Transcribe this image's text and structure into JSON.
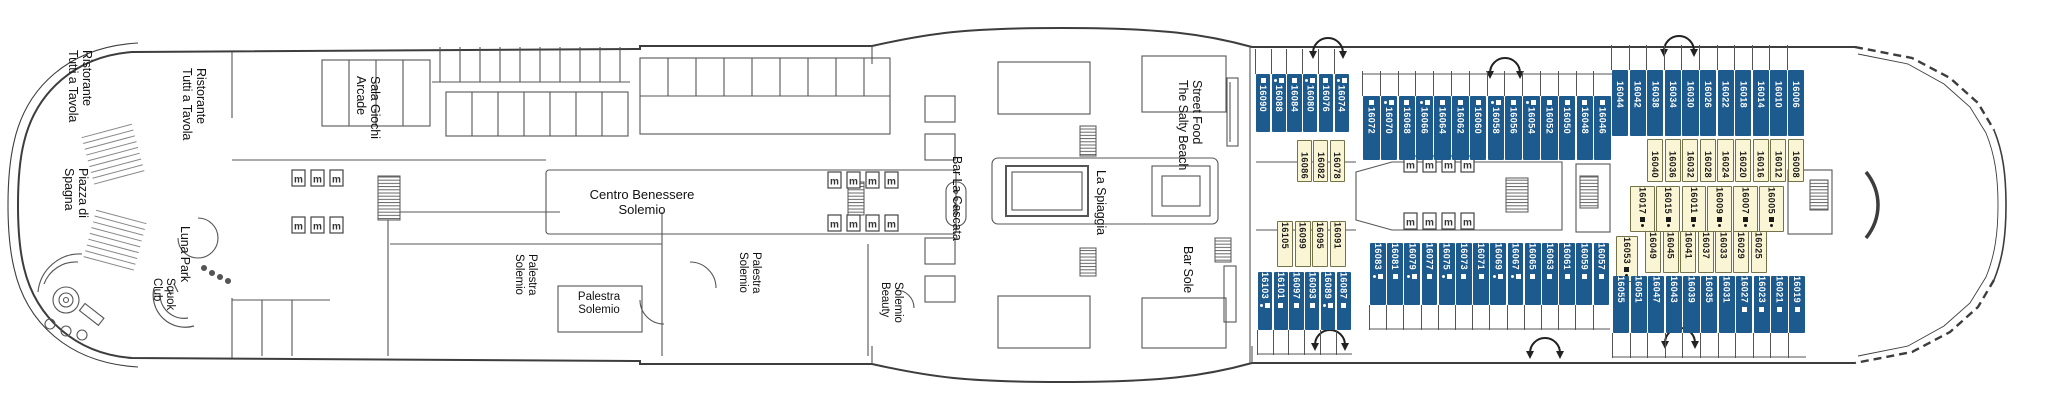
{
  "deck_plan": {
    "colors": {
      "balcony_cabin": "#1d5a8e",
      "inside_cabin": "#faf5d4",
      "inside_cabin_border": "#73734a",
      "outline": "#3d3d3d",
      "label_text": "#111111"
    },
    "legend_icons": {
      "elevator_label": "m",
      "berth_square": "square",
      "berth_dot": "dot"
    },
    "ship_areas": {
      "ristorante_aft": {
        "label": "Ristorante\nTutti a Tavola"
      },
      "ristorante_fwd": {
        "label": "Ristorante\nTutti a Tavola"
      },
      "piazza_di_spagna": {
        "label": "Piazza di\nSpagna"
      },
      "luna_park": {
        "label": "Luna Park"
      },
      "squok_club": {
        "label": "Squok\nClub"
      },
      "sala_giochi_arcade": {
        "label": "Sala Giochi\nArcade"
      },
      "centro_benessere": {
        "label": "Centro Benessere\nSolemio"
      },
      "palestra_solemio_port": {
        "label": "Palestra\nSolemio"
      },
      "palestra_solemio_room": {
        "label": "Palestra\nSolemio"
      },
      "palestra_solemio_stbd": {
        "label": "Palestra\nSolemio"
      },
      "solemio_beauty": {
        "label": "Solemio\nBeauty"
      },
      "bar_la_cascata": {
        "label": "Bar La Cascata"
      },
      "la_spiaggia": {
        "label": "La Spiaggia"
      },
      "salty_beach": {
        "label": "The Salty Beach\nStreet Food"
      },
      "bar_sole": {
        "label": "Bar Sole"
      }
    },
    "cabins": {
      "groups": [
        {
          "id": "t1",
          "type": "balcony",
          "side": "port",
          "cabins": [
            {
              "num": "16090",
              "icons": [
                "square"
              ]
            },
            {
              "num": "16088",
              "icons": [
                "dot",
                "square"
              ]
            },
            {
              "num": "16084",
              "icons": [
                "square"
              ]
            },
            {
              "num": "16080",
              "icons": [
                "dot",
                "square"
              ]
            },
            {
              "num": "16076",
              "icons": [
                "square"
              ]
            },
            {
              "num": "16074",
              "icons": [
                "dot",
                "square"
              ]
            }
          ]
        },
        {
          "id": "t2",
          "type": "balcony",
          "side": "port",
          "cabins": [
            {
              "num": "16072",
              "icons": [
                "square"
              ]
            },
            {
              "num": "16070",
              "icons": [
                "dot",
                "square"
              ]
            },
            {
              "num": "16068",
              "icons": [
                "square"
              ]
            },
            {
              "num": "16066",
              "icons": [
                "dot",
                "square"
              ]
            },
            {
              "num": "16064",
              "icons": [
                "square"
              ]
            },
            {
              "num": "16062",
              "icons": [
                "square"
              ]
            },
            {
              "num": "16060",
              "icons": [
                "square"
              ]
            },
            {
              "num": "16058",
              "icons": [
                "dot",
                "square"
              ]
            },
            {
              "num": "16056",
              "icons": [
                "square"
              ]
            },
            {
              "num": "16054",
              "icons": [
                "dot",
                "square"
              ]
            },
            {
              "num": "16052",
              "icons": [
                "square"
              ]
            },
            {
              "num": "16050",
              "icons": [
                "square"
              ]
            },
            {
              "num": "16048",
              "icons": [
                "square"
              ]
            },
            {
              "num": "16046",
              "icons": [
                "square"
              ]
            }
          ]
        },
        {
          "id": "t3",
          "type": "balcony",
          "side": "port",
          "cabins": [
            {
              "num": "16044",
              "icons": []
            },
            {
              "num": "16042",
              "icons": []
            },
            {
              "num": "16038",
              "icons": []
            },
            {
              "num": "16034",
              "icons": []
            },
            {
              "num": "16030",
              "icons": []
            },
            {
              "num": "16026",
              "icons": []
            },
            {
              "num": "16022",
              "icons": []
            },
            {
              "num": "16018",
              "icons": []
            },
            {
              "num": "16014",
              "icons": []
            },
            {
              "num": "16010",
              "icons": []
            },
            {
              "num": "16006",
              "icons": []
            }
          ]
        },
        {
          "id": "y1",
          "type": "inside",
          "side": "port",
          "cabins": [
            {
              "num": "16086",
              "icons": []
            },
            {
              "num": "16082",
              "icons": []
            },
            {
              "num": "16078",
              "icons": []
            }
          ]
        },
        {
          "id": "y2",
          "type": "inside",
          "side": "port",
          "cabins": [
            {
              "num": "16040",
              "icons": []
            },
            {
              "num": "16036",
              "icons": []
            },
            {
              "num": "16032",
              "icons": []
            },
            {
              "num": "16028",
              "icons": []
            },
            {
              "num": "16024",
              "icons": []
            },
            {
              "num": "16020",
              "icons": []
            },
            {
              "num": "16016",
              "icons": []
            },
            {
              "num": "16012",
              "icons": []
            },
            {
              "num": "16008",
              "icons": []
            }
          ]
        },
        {
          "id": "y3",
          "type": "inside",
          "side": "center",
          "cabins": [
            {
              "num": "16017",
              "icons": [
                "square",
                "dot"
              ]
            },
            {
              "num": "16015",
              "icons": [
                "square",
                "dot"
              ]
            },
            {
              "num": "16011",
              "icons": [
                "square",
                "dot"
              ]
            },
            {
              "num": "16009",
              "icons": [
                "square",
                "dot"
              ]
            },
            {
              "num": "16007",
              "icons": [
                "square",
                "dot"
              ]
            },
            {
              "num": "16005",
              "icons": [
                "square",
                "dot"
              ]
            }
          ]
        },
        {
          "id": "y4",
          "type": "inside",
          "side": "center",
          "cabins": [
            {
              "num": "16053",
              "icons": [
                "square",
                "dot"
              ]
            }
          ]
        },
        {
          "id": "y5",
          "type": "inside",
          "side": "starboard",
          "cabins": [
            {
              "num": "16049",
              "icons": []
            },
            {
              "num": "16045",
              "icons": []
            },
            {
              "num": "16041",
              "icons": []
            },
            {
              "num": "16037",
              "icons": []
            },
            {
              "num": "16033",
              "icons": []
            },
            {
              "num": "16029",
              "icons": []
            },
            {
              "num": "16025",
              "icons": []
            }
          ]
        },
        {
          "id": "y6",
          "type": "inside",
          "side": "starboard",
          "cabins": [
            {
              "num": "16105",
              "icons": []
            },
            {
              "num": "16099",
              "icons": []
            },
            {
              "num": "16095",
              "icons": []
            },
            {
              "num": "16091",
              "icons": []
            }
          ]
        },
        {
          "id": "b1",
          "type": "balcony",
          "side": "starboard",
          "cabins": [
            {
              "num": "16103",
              "icons": [
                "dot",
                "square"
              ]
            },
            {
              "num": "16101",
              "icons": [
                "square"
              ]
            },
            {
              "num": "16097",
              "icons": [
                "square"
              ]
            },
            {
              "num": "16093",
              "icons": [
                "square"
              ]
            },
            {
              "num": "16089",
              "icons": [
                "dot",
                "square"
              ]
            },
            {
              "num": "16087",
              "icons": [
                "square"
              ]
            }
          ]
        },
        {
          "id": "b2",
          "type": "balcony",
          "side": "starboard",
          "cabins": [
            {
              "num": "16083",
              "icons": [
                "dot",
                "square"
              ]
            },
            {
              "num": "16081",
              "icons": [
                "square"
              ]
            },
            {
              "num": "16079",
              "icons": [
                "dot",
                "square"
              ]
            },
            {
              "num": "16077",
              "icons": [
                "square"
              ]
            },
            {
              "num": "16075",
              "icons": [
                "dot",
                "square"
              ]
            },
            {
              "num": "16073",
              "icons": [
                "square"
              ]
            },
            {
              "num": "16071",
              "icons": [
                "square"
              ]
            },
            {
              "num": "16069",
              "icons": [
                "dot",
                "square"
              ]
            },
            {
              "num": "16067",
              "icons": [
                "dot",
                "square"
              ]
            },
            {
              "num": "16065",
              "icons": [
                "square"
              ]
            },
            {
              "num": "16063",
              "icons": [
                "square"
              ]
            },
            {
              "num": "16061",
              "icons": [
                "square"
              ]
            },
            {
              "num": "16059",
              "icons": [
                "square"
              ]
            },
            {
              "num": "16057",
              "icons": [
                "square"
              ]
            }
          ]
        },
        {
          "id": "b3",
          "type": "balcony",
          "side": "starboard",
          "cabins": [
            {
              "num": "16055",
              "icons": []
            },
            {
              "num": "16051",
              "icons": []
            },
            {
              "num": "16047",
              "icons": []
            },
            {
              "num": "16043",
              "icons": []
            },
            {
              "num": "16039",
              "icons": []
            },
            {
              "num": "16035",
              "icons": []
            },
            {
              "num": "16031",
              "icons": []
            },
            {
              "num": "16027",
              "icons": [
                "square"
              ]
            },
            {
              "num": "16023",
              "icons": [
                "square"
              ]
            },
            {
              "num": "16021",
              "icons": [
                "square"
              ]
            },
            {
              "num": "16019",
              "icons": [
                "square"
              ]
            }
          ]
        }
      ]
    }
  }
}
